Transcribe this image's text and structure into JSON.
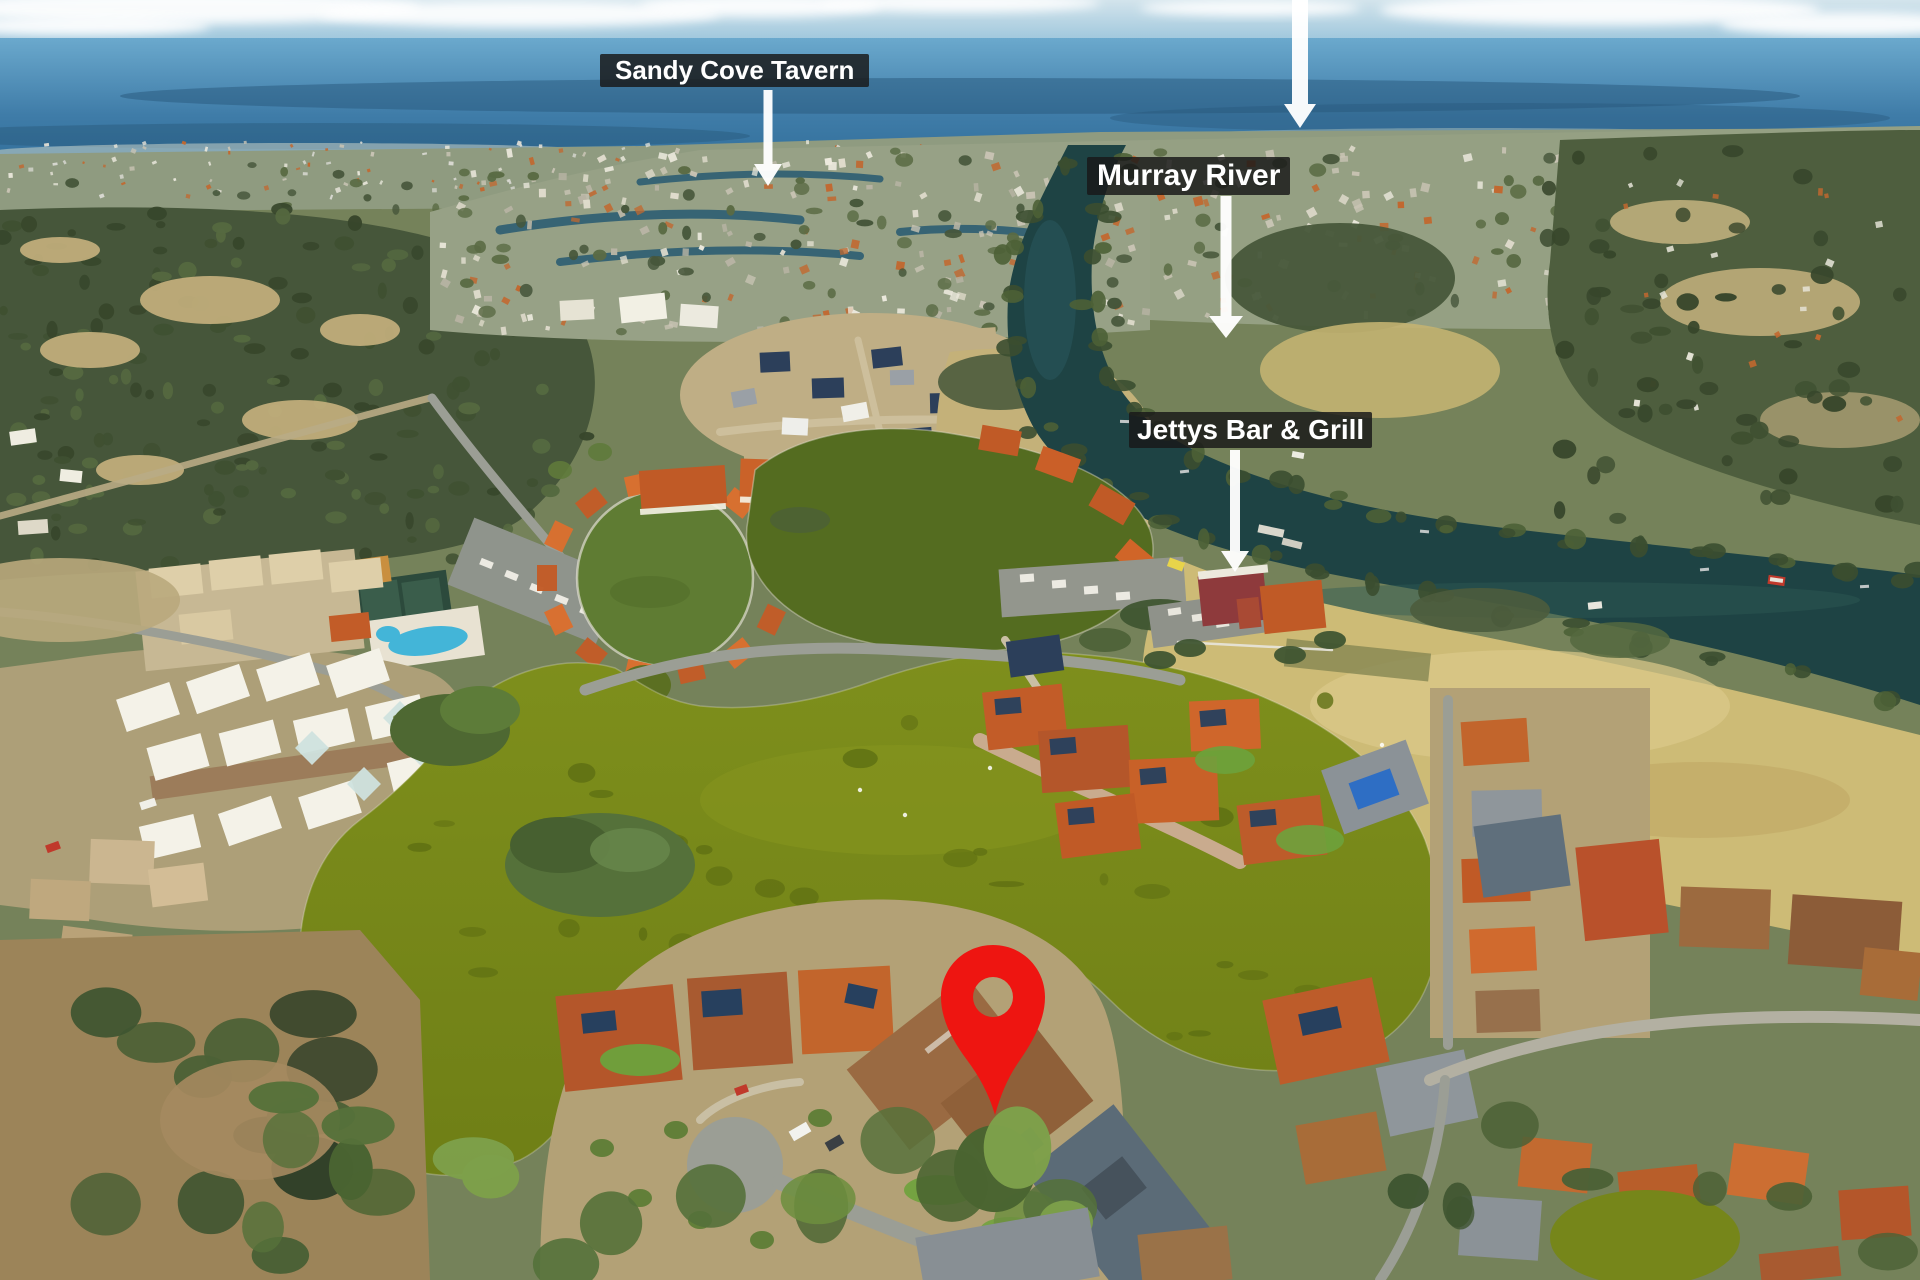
{
  "image": {
    "kind": "aerial-drone-photograph",
    "subject": "waterfront canal estate with lagoon, Murray River and surrounding suburbs"
  },
  "annotations": {
    "labels": [
      {
        "id": "sandy-cove-tavern",
        "text": "Sandy Cove Tavern"
      },
      {
        "id": "murray-river",
        "text": "Murray River"
      },
      {
        "id": "jettys-bar-grill",
        "text": "Jettys Bar & Grill"
      }
    ],
    "marker": {
      "type": "location-pin",
      "color": "#ee1511"
    },
    "style": {
      "label_bg": "rgba(25,25,25,0.84)",
      "label_fg": "#ffffff",
      "arrow_color": "#ffffff"
    }
  },
  "scene_colors": {
    "sky": "#8fc0d8",
    "estuary": "#4f92bb",
    "river": "#1e4344",
    "lagoon": "#76861a",
    "resort_pond": "#5f7c33",
    "dry_field": "#cdbb76",
    "bushland": "#46563a",
    "roof_terracotta": "#c25c28",
    "pool": "#43b5d8"
  }
}
